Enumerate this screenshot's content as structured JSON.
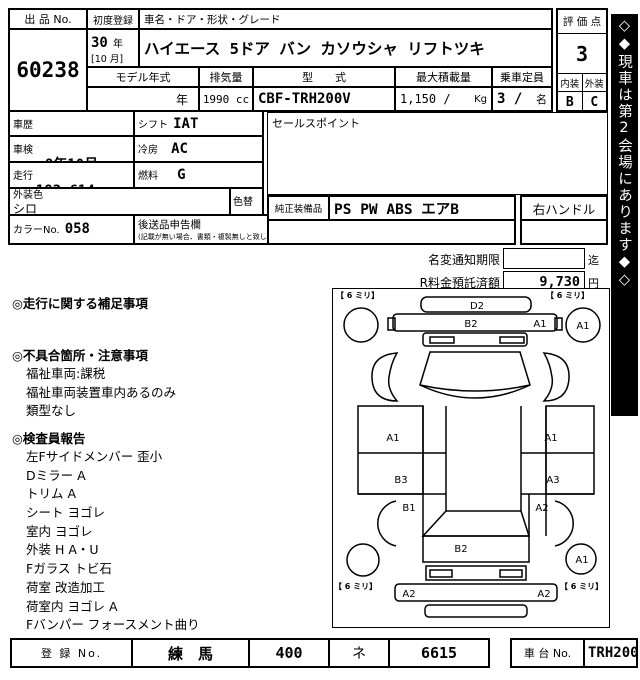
{
  "header": {
    "auction_no_label": "出 品 No.",
    "auction_no": "60238",
    "first_reg_label": "初度登録",
    "first_reg_year": "30",
    "first_reg_year_unit": "年",
    "first_reg_month": "[10 月]",
    "car_name_label": "車名・ドア・形状・グレード",
    "car_name": "ハイエース 5ドア バン カソウシャ リフトツキ",
    "model_year_label": "モデル年式",
    "model_year_value": "年",
    "displacement_label": "排気量",
    "displacement_value": "1990 cc",
    "model_code_label": "型　　式",
    "model_code_value": "CBF-TRH200V",
    "max_load_label": "最大積載量",
    "max_load_value": "1,150 /",
    "max_load_unit": "Kg",
    "capacity_label": "乗車定員",
    "capacity_value": "3 /",
    "capacity_unit": "名",
    "grade_label": "評 価 点",
    "grade_value": "3",
    "interior_label": "内装",
    "exterior_label": "外装",
    "interior_value": "B",
    "exterior_value": "C"
  },
  "details": {
    "history_label": "車歴",
    "history_value": "",
    "shaken_label": "車検",
    "shaken_value": "8年10月",
    "mileage_label": "走行",
    "mileage_value": "183,614",
    "mileage_unit": "km",
    "shift_label": "シフト",
    "shift_value": "IAT",
    "ac_label": "冷房",
    "ac_value": "AC",
    "fuel_label": "燃料",
    "fuel_value": "G",
    "color_label": "外装色",
    "color_value": "シロ",
    "color_change_label": "色替",
    "color_no_label": "カラーNo.",
    "color_no_value": "058",
    "later_items_label": "後送品申告欄",
    "later_items_note": "(記載が無い場合、書類・複製無しと致します)",
    "sales_point_label": "セールスポイント",
    "oem_equipment_label": "純正装備品",
    "oem_equipment_value": "PS PW ABS エアB",
    "handle_value": "右ハンドル"
  },
  "fees": {
    "name_change_label": "名変通知期限",
    "name_change_value": "",
    "name_change_suffix": "迄",
    "recycle_label": "R料金預託済額",
    "recycle_value": "9,730",
    "recycle_unit": "円"
  },
  "notes": {
    "section1_title": "◎走行に関する補足事項",
    "section2_title": "◎不具合箇所・注意事項",
    "section2_items": [
      "福祉車両:課税",
      "福祉車両装置車内あるのみ",
      "類型なし"
    ],
    "section3_title": "◎検査員報告",
    "section3_items": [
      "左Fサイドメンバー 歪小",
      "Dミラー A",
      "トリム A",
      "シート ヨゴレ",
      "室内 ヨゴレ",
      "外装 H A・U",
      "Fガラス トビ石",
      "荷室 改造加工",
      "荷室内 ヨゴレ A",
      "Fバンパー フォースメント曲り"
    ]
  },
  "diagram": {
    "tire_tl": "【 6 ミリ】",
    "tire_tr": "【 6 ミリ】",
    "tire_bl": "【 6 ミリ】",
    "tire_br": "【 6 ミリ】",
    "rear_door": "D2",
    "rear_bumper": "B2",
    "rear_bumper_end": "A1",
    "rear_right_circle": "A1",
    "left_panel_upper": "A1",
    "right_panel_upper": "A1",
    "left_panel_lower": "B3",
    "right_panel_lower": "A3",
    "left_front_fender": "B1",
    "right_front_fender": "A2",
    "hood": "B2",
    "front_bumper_left": "A2",
    "front_bumper_right": "A2",
    "front_right_circle": "A1"
  },
  "footer": {
    "reg_no_label": "登 録 No.",
    "reg_area": "練　馬",
    "reg_class": "400",
    "reg_kana": "ネ",
    "reg_number": "6615",
    "chassis_label": "車 台 No.",
    "chassis_value": "TRH200-0284646"
  },
  "sidebar": {
    "top_diamonds": "◇◆",
    "text": "現車は第2会場にあります",
    "bottom_diamonds": "◆◇"
  }
}
